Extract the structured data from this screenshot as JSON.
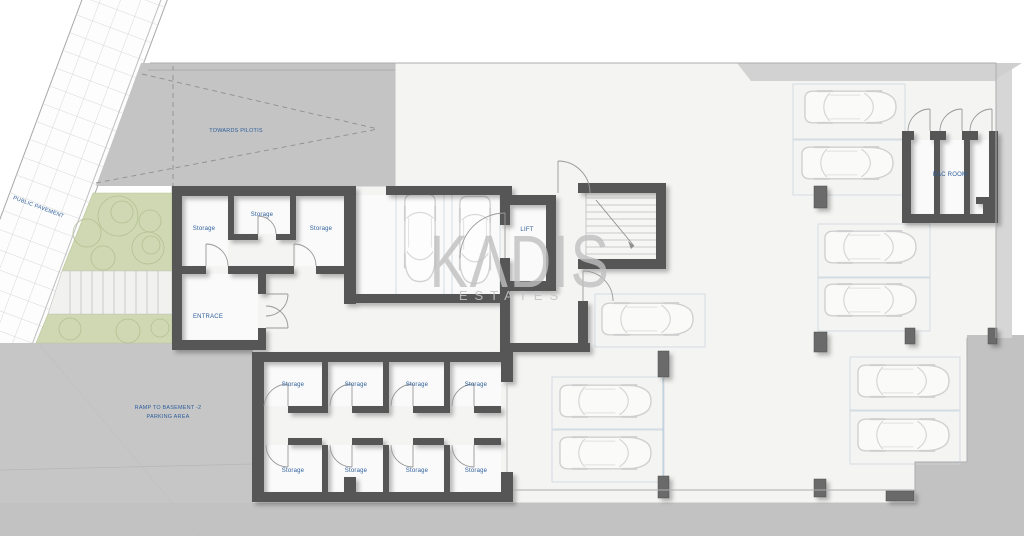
{
  "plan": {
    "watermark": {
      "brand": "KΛDIS",
      "subtitle": "ESTATES"
    },
    "labels": {
      "public_pavement": "PUBLIC PAVEMENT",
      "towards_pilotis": "TOWARDS PILOTIS",
      "entrance": "ENTRACE",
      "lift": "LIFT",
      "eac_room": "EAC ROOM",
      "storage": "Storage",
      "ramp_line1": "RAMP TO BASEMENT -2",
      "ramp_line2": "PARKING AREA"
    },
    "colors": {
      "label_blue": "#2e5f9b",
      "wall_gray": "#575757",
      "outdoor_gray": "#c4c4c4",
      "ramp_gray": "#c6c6c6",
      "landscape_green": "#cfd8b3",
      "interior_white": "#f4f4f3"
    }
  }
}
